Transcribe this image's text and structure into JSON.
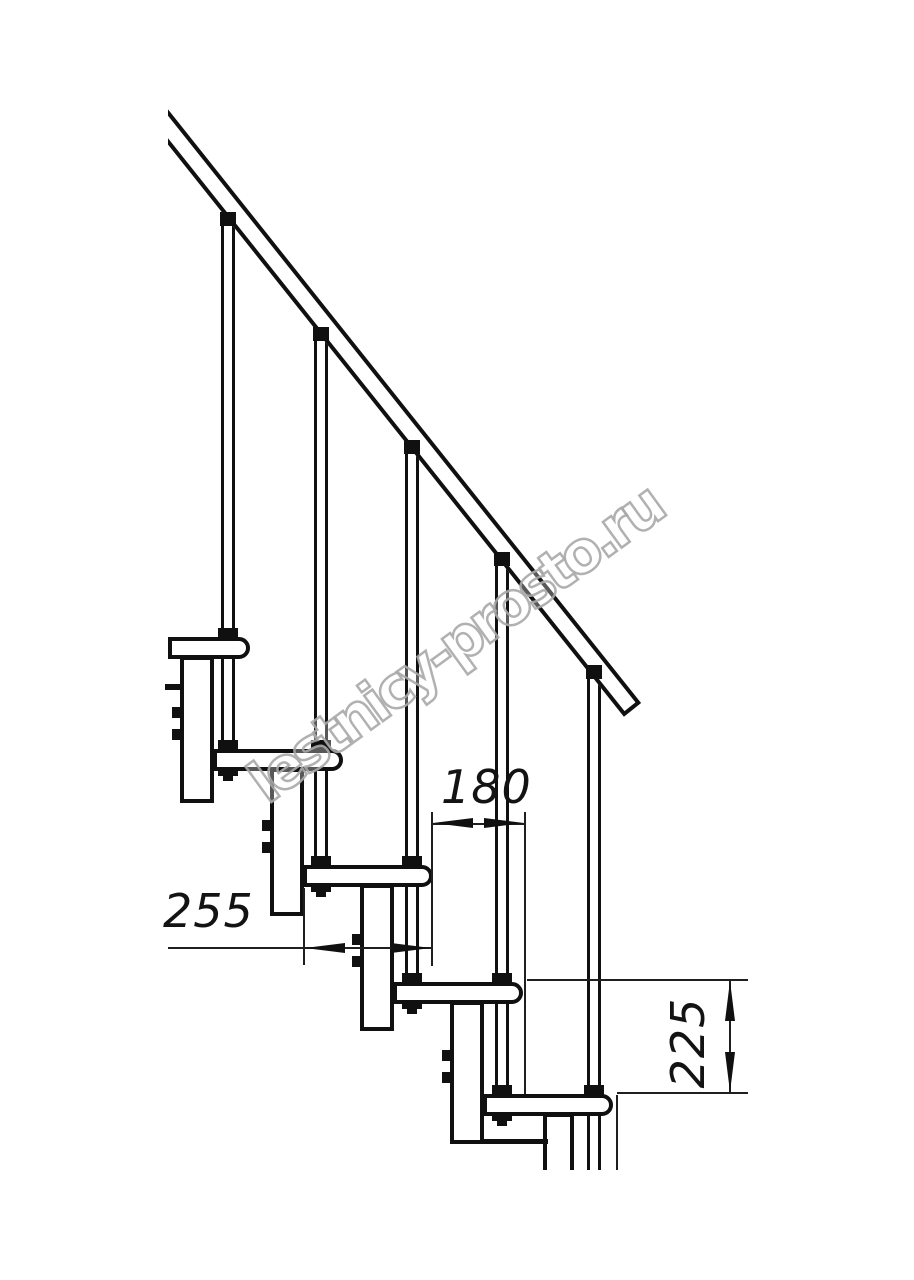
{
  "watermark": {
    "text": "lestnicy-prosto.ru"
  },
  "dimensions": {
    "tread_depth_mm": "255",
    "step_run_mm": "180",
    "riser_height_mm": "225"
  }
}
